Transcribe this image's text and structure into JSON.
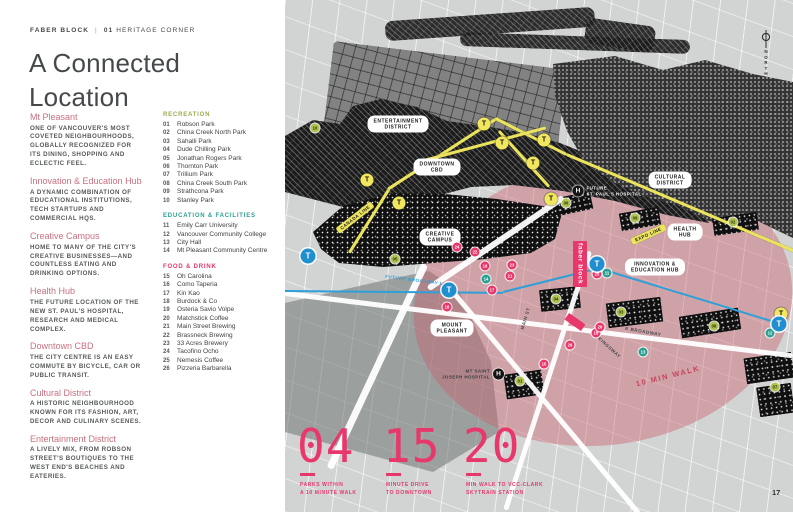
{
  "colors": {
    "accent-pink": "#e8376b",
    "rose": "#c8707f",
    "lime": "#aec24e",
    "teal": "#2ba092",
    "line-yellow": "#ece45e",
    "line-blue": "#2f9fd8",
    "ink": "#3f4244"
  },
  "header": {
    "brand": "FABER BLOCK",
    "divider": "|",
    "section_no": "01",
    "section_name": "HERITAGE CORNER"
  },
  "title": "A Connected\nLocation",
  "sidebar": {
    "sections": [
      {
        "heading": "Mt Pleasant",
        "body": "ONE OF VANCOUVER'S MOST COVETED NEIGHBOURHOODS, GLOBALLY RECOGNIZED FOR ITS DINING, SHOPPING AND ECLECTIC FEEL."
      },
      {
        "heading": "Innovation & Education Hub",
        "body": "A DYNAMIC COMBINATION OF EDUCATIONAL INSTITUTIONS, TECH STARTUPS AND COMMERCIAL HQS."
      },
      {
        "heading": "Creative Campus",
        "body": "HOME TO MANY OF THE CITY'S CREATIVE BUSINESSES—AND COUNTLESS EATING AND DRINKING OPTIONS."
      },
      {
        "heading": "Health Hub",
        "body": "THE FUTURE LOCATION OF THE NEW ST. PAUL'S HOSPITAL, RESEARCH AND MEDICAL COMPLEX."
      },
      {
        "heading": "Downtown CBD",
        "body": "THE CITY CENTRE IS AN EASY COMMUTE BY BICYCLE, CAR OR PUBLIC TRANSIT."
      },
      {
        "heading": "Cultural District",
        "body": "A HISTORIC NEIGHBOURHOOD KNOWN FOR ITS FASHION, ART, DECOR AND CULINARY SCENES."
      },
      {
        "heading": "Entertainment District",
        "body": "A LIVELY MIX, FROM ROBSON STREET'S BOUTIQUES TO THE WEST END'S BEACHES AND EATERIES."
      }
    ]
  },
  "legend": {
    "sections": [
      {
        "heading": "RECREATION",
        "color": "#9cab4d",
        "items": [
          {
            "no": "01",
            "name": "Robson Park"
          },
          {
            "no": "02",
            "name": "China Creek North Park"
          },
          {
            "no": "03",
            "name": "Sahalli Park"
          },
          {
            "no": "04",
            "name": "Dude Chilling Park"
          },
          {
            "no": "05",
            "name": "Jonathan Rogers Park"
          },
          {
            "no": "06",
            "name": "Thornton Park"
          },
          {
            "no": "07",
            "name": "Trillium Park"
          },
          {
            "no": "08",
            "name": "China Creek South Park"
          },
          {
            "no": "09",
            "name": "Strathcona Park"
          },
          {
            "no": "10",
            "name": "Stanley Park"
          }
        ]
      },
      {
        "heading": "EDUCATION & FACILITIES",
        "color": "#2ba092",
        "items": [
          {
            "no": "11",
            "name": "Emily Carr University"
          },
          {
            "no": "12",
            "name": "Vancouver Community College"
          },
          {
            "no": "13",
            "name": "City Hall"
          },
          {
            "no": "14",
            "name": "Mt Pleasant Community Centre"
          }
        ]
      },
      {
        "heading": "FOOD & DRINK",
        "color": "#e8376b",
        "items": [
          {
            "no": "15",
            "name": "Oh Carolina"
          },
          {
            "no": "16",
            "name": "Como Taperia"
          },
          {
            "no": "17",
            "name": "Kin Kao"
          },
          {
            "no": "18",
            "name": "Burdock & Co"
          },
          {
            "no": "19",
            "name": "Osteria Savio Volpe"
          },
          {
            "no": "20",
            "name": "Matchstick Coffee"
          },
          {
            "no": "21",
            "name": "Main Street Brewing"
          },
          {
            "no": "22",
            "name": "Brassneck Brewing"
          },
          {
            "no": "23",
            "name": "33 Acres Brewery"
          },
          {
            "no": "24",
            "name": "Tacofino Ocho"
          },
          {
            "no": "25",
            "name": "Nemesis Coffee"
          },
          {
            "no": "26",
            "name": "Pizzeria Barbarella"
          }
        ]
      }
    ]
  },
  "map": {
    "compass": "NORTH",
    "site_label": "faber block",
    "walk_radius_label": "10 MIN WALK",
    "hospital_symbol": "H",
    "hospitals": {
      "st_pauls": "FUTURE\nST. PAUL'S HOSPITAL",
      "st_joseph": "MT SAINT\nJOSEPH HOSPITAL"
    },
    "line_labels": {
      "canada": "CANADA LINE",
      "expo": "EXPO LINE",
      "broadway": "FUTURE BROADWAY LINE"
    },
    "road_labels": {
      "main": "MAIN ST",
      "e_broadway": "E BROADWAY",
      "kingsway": "KINGSWAY"
    },
    "districts": [
      {
        "lines": [
          "ENTERTAINMENT",
          "DISTRICT"
        ],
        "x": 113,
        "y": 124
      },
      {
        "lines": [
          "DOWNTOWN",
          "CBD"
        ],
        "x": 152,
        "y": 167
      },
      {
        "lines": [
          "CULTURAL",
          "DISTRICT"
        ],
        "x": 385,
        "y": 180
      },
      {
        "lines": [
          "HEALTH",
          "HUB"
        ],
        "x": 400,
        "y": 232
      },
      {
        "lines": [
          "CREATIVE",
          "CAMPUS"
        ],
        "x": 155,
        "y": 237
      },
      {
        "lines": [
          "INNOVATION &",
          "EDUCATION HUB"
        ],
        "x": 370,
        "y": 267
      },
      {
        "lines": [
          "MOUNT",
          "PLEASANT"
        ],
        "x": 167,
        "y": 328
      }
    ],
    "transit": {
      "symbol": "T",
      "yellow": [
        {
          "x": 199,
          "y": 124
        },
        {
          "x": 217,
          "y": 143
        },
        {
          "x": 259,
          "y": 140
        },
        {
          "x": 248,
          "y": 163
        },
        {
          "x": 82,
          "y": 180
        },
        {
          "x": 114,
          "y": 203
        },
        {
          "x": 266,
          "y": 199
        },
        {
          "x": 496,
          "y": 314
        }
      ],
      "blue": [
        {
          "x": 23,
          "y": 256
        },
        {
          "x": 164,
          "y": 290
        },
        {
          "x": 312,
          "y": 264
        },
        {
          "x": 494,
          "y": 324
        }
      ]
    },
    "markers": {
      "parks": [
        {
          "n": "10",
          "x": 30,
          "y": 128
        },
        {
          "n": "06",
          "x": 281,
          "y": 203
        },
        {
          "n": "09",
          "x": 350,
          "y": 218
        },
        {
          "n": "02",
          "x": 448,
          "y": 222
        },
        {
          "n": "05",
          "x": 110,
          "y": 259
        },
        {
          "n": "04",
          "x": 271,
          "y": 299
        },
        {
          "n": "03",
          "x": 336,
          "y": 312
        },
        {
          "n": "08",
          "x": 429,
          "y": 326
        },
        {
          "n": "01",
          "x": 235,
          "y": 381
        },
        {
          "n": "07",
          "x": 490,
          "y": 387
        }
      ],
      "education": [
        {
          "n": "11",
          "x": 322,
          "y": 273
        },
        {
          "n": "12",
          "x": 485,
          "y": 333
        },
        {
          "n": "13",
          "x": 358,
          "y": 352
        },
        {
          "n": "14",
          "x": 201,
          "y": 279
        }
      ],
      "food": [
        {
          "n": "15",
          "x": 259,
          "y": 364
        },
        {
          "n": "16",
          "x": 200,
          "y": 266
        },
        {
          "n": "17",
          "x": 207,
          "y": 290
        },
        {
          "n": "18",
          "x": 162,
          "y": 307
        },
        {
          "n": "19",
          "x": 311,
          "y": 333
        },
        {
          "n": "20",
          "x": 315,
          "y": 327
        },
        {
          "n": "21",
          "x": 225,
          "y": 276
        },
        {
          "n": "22",
          "x": 190,
          "y": 252
        },
        {
          "n": "23",
          "x": 227,
          "y": 265
        },
        {
          "n": "24",
          "x": 172,
          "y": 247
        },
        {
          "n": "25",
          "x": 312,
          "y": 274
        },
        {
          "n": "26",
          "x": 285,
          "y": 345
        }
      ]
    }
  },
  "stats": [
    {
      "value": "04",
      "label_lines": [
        "PARKS WITHIN",
        "A 10 MINUTE WALK"
      ]
    },
    {
      "value": "15",
      "label_lines": [
        "MINUTE DRIVE",
        "TO DOWNTOWN"
      ]
    },
    {
      "value": "20",
      "label_lines": [
        "MIN WALK TO VCC-CLARK",
        "SKYTRAIN STATION"
      ]
    }
  ],
  "page_number": "17"
}
